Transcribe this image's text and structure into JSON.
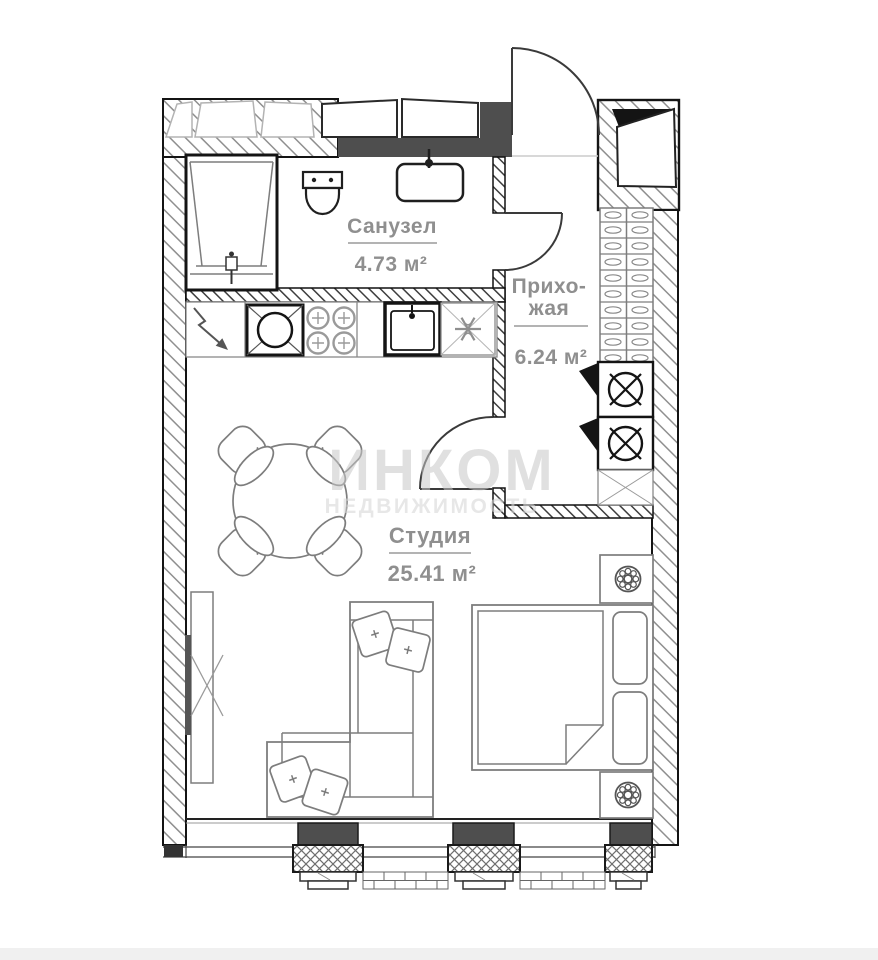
{
  "plan": {
    "title": "apartment-floor-plan",
    "watermark": {
      "line1": "ИНКОМ",
      "line2": "НЕДВИЖИМОСТЬ",
      "color": "#c7c7c7",
      "color2": "#d8d8d8"
    },
    "rooms": {
      "bathroom": {
        "name": "Санузел",
        "area": "4.73 м²"
      },
      "hallway": {
        "name_line1": "Прихо-",
        "name_line2": "жая",
        "area": "6.24 м²"
      },
      "studio": {
        "name": "Студия",
        "area": "25.41 м²"
      }
    },
    "label_color": "#8f8f8f",
    "colors": {
      "wall_dark": "#4e4e4e",
      "wall_line": "#141414",
      "furniture_line": "#7d7d7d",
      "fixture_line": "#1f1f1f",
      "bottom_strip": "#f0f0f0"
    },
    "fixtures": [
      "bathtub",
      "toilet",
      "washbasin",
      "kitchen-corner-unit",
      "stove",
      "kitchen-sink",
      "fridge",
      "washing-machine",
      "washing-machine",
      "shoe-cabinet",
      "dining-table",
      "sofa",
      "bed",
      "nightstand-lamp",
      "nightstand-lamp",
      "tv-unit"
    ]
  }
}
